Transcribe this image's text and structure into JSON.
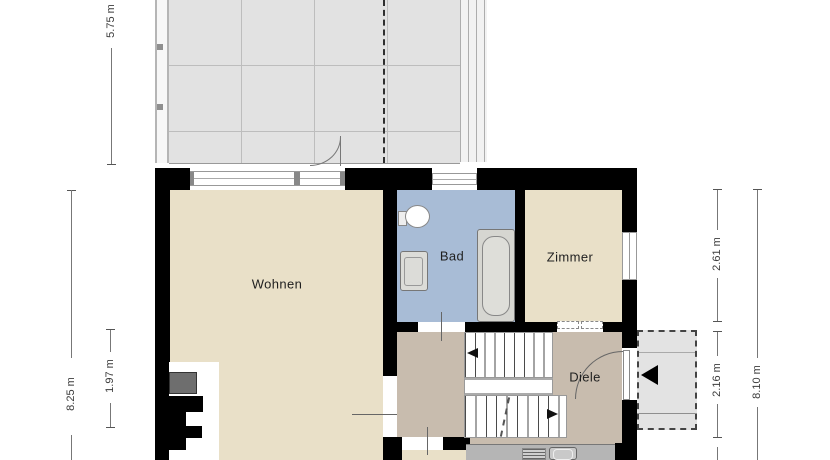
{
  "floorplan": {
    "type": "floor-plan",
    "language": "de",
    "rooms": {
      "wohnen": {
        "label": "Wohnen"
      },
      "bad": {
        "label": "Bad"
      },
      "zimmer": {
        "label": "Zimmer"
      },
      "diele": {
        "label": "Diele"
      }
    },
    "dimensions": {
      "d575": {
        "label": "5.75 m",
        "side": "top-left",
        "measures": "terrace depth"
      },
      "d825": {
        "label": "8.25 m",
        "side": "left-outer"
      },
      "d197": {
        "label": "1.97 m",
        "side": "left-inner"
      },
      "d261": {
        "label": "2.61 m",
        "side": "right-inner"
      },
      "d216": {
        "label": "2.16 m",
        "side": "right-inner"
      },
      "d810": {
        "label": "8.10 m",
        "side": "right-outer"
      }
    },
    "icons": {
      "stairs_up_arrow": "left-triangle",
      "stairs_down_arrow": "right-triangle",
      "entrance_arrow": "left-triangle"
    },
    "colors": {
      "room_floor": "#e9e0c8",
      "bathroom_floor": "#a8bcd6",
      "hall_floor": "#c8bcae",
      "terrace": "#e2e2e2",
      "walls": "#000000",
      "counter": "#b5b5b5",
      "porch": "#e3e3e3"
    }
  }
}
